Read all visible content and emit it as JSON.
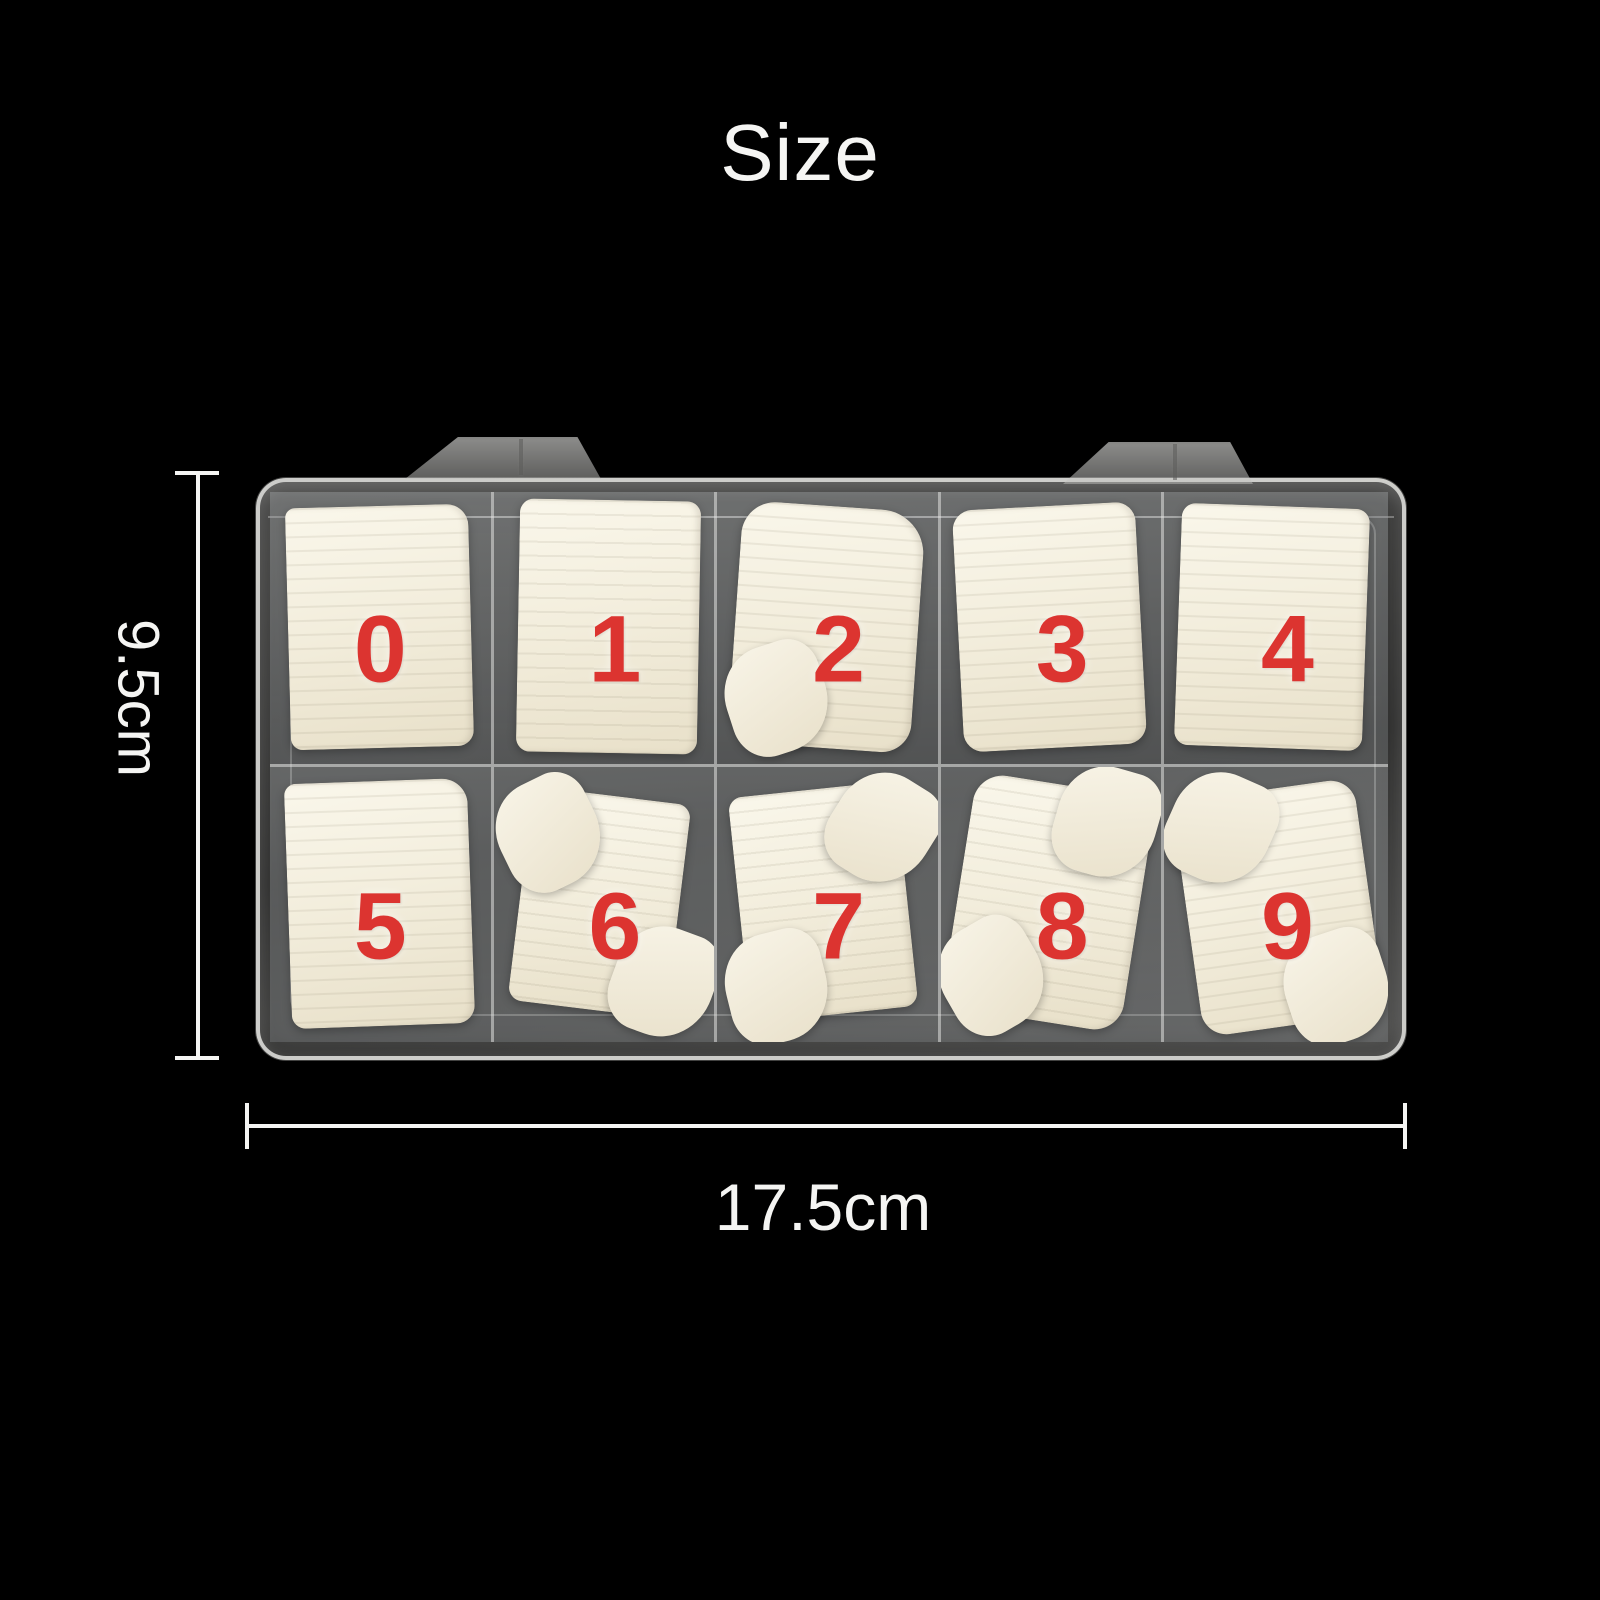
{
  "title": "Size",
  "colors": {
    "background": "#000000",
    "number_red": "#dc3430",
    "label_white": "#f5f5f3",
    "plastic_light": "#d6d5d2",
    "tip_cream": "#f3eedd"
  },
  "box": {
    "description": "clear-plastic-organizer-with-false-nail-tips",
    "compartments": [
      {
        "label": "0"
      },
      {
        "label": "1"
      },
      {
        "label": "2"
      },
      {
        "label": "3"
      },
      {
        "label": "4"
      },
      {
        "label": "5"
      },
      {
        "label": "6"
      },
      {
        "label": "7"
      },
      {
        "label": "8"
      },
      {
        "label": "9"
      }
    ]
  },
  "dimensions": {
    "height": {
      "label": "9.5cm"
    },
    "width": {
      "label": "17.5cm"
    }
  }
}
